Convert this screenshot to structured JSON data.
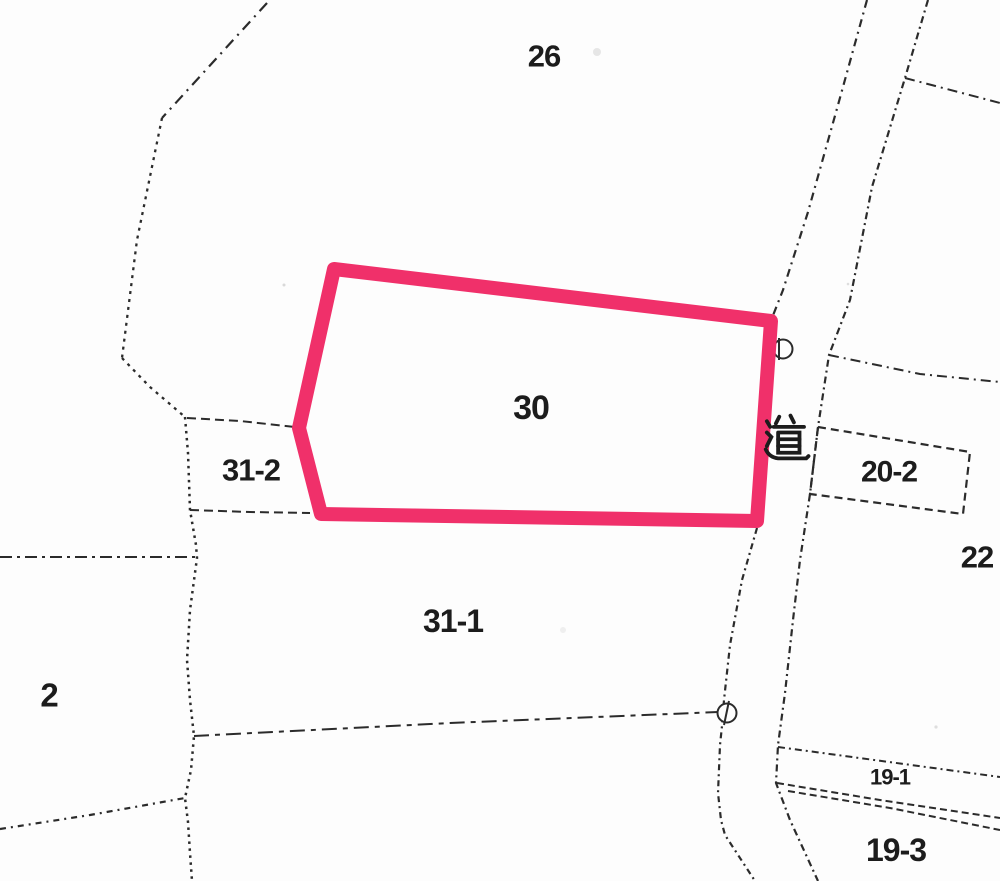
{
  "map": {
    "description": "cadastral-parcel-map",
    "canvas": {
      "width": 1000,
      "height": 881,
      "background": "#fdfdfd"
    },
    "colors": {
      "line": "#2b2b2b",
      "label": "#1c1c1c",
      "highlight": "#f0306a",
      "speck": "#c9c9c9"
    },
    "highlight_parcel": {
      "parcel": "30",
      "points": "334,269 771,321 757,521 321,514 299,428",
      "stroke_width": 14
    },
    "labels": [
      {
        "id": "parcel-26",
        "text": "26",
        "x": 544,
        "y": 56,
        "size": 31
      },
      {
        "id": "parcel-30",
        "text": "30",
        "x": 531,
        "y": 408,
        "size": 34
      },
      {
        "id": "parcel-31-2",
        "text": "31-2",
        "x": 251,
        "y": 470,
        "size": 31
      },
      {
        "id": "parcel-31-1",
        "text": "31-1",
        "x": 453,
        "y": 621,
        "size": 32
      },
      {
        "id": "parcel-2",
        "text": "2",
        "x": 49,
        "y": 695,
        "size": 33
      },
      {
        "id": "road-kanji",
        "text": "道",
        "x": 786,
        "y": 437,
        "size": 45,
        "kanji": true
      },
      {
        "id": "parcel-20-2",
        "text": "20-2",
        "x": 889,
        "y": 472,
        "size": 30
      },
      {
        "id": "parcel-22",
        "text": "22",
        "x": 977,
        "y": 557,
        "size": 31
      },
      {
        "id": "parcel-19-1",
        "text": "19-1",
        "x": 890,
        "y": 777,
        "size": 22
      },
      {
        "id": "parcel-19-3",
        "text": "19-3",
        "x": 896,
        "y": 850,
        "size": 32
      }
    ],
    "boundaries": [
      {
        "name": "northwest-chain-upper",
        "points": "267,3 162,118",
        "dash": "11 6 2 6",
        "width": 2.2
      },
      {
        "name": "northwest-dotted-mid",
        "points": "162,118 137,240 122,358",
        "dash": "3 5",
        "width": 2.3
      },
      {
        "name": "northwest-dotted-lower",
        "points": "122,358 150,387 185,417",
        "dash": "3 5",
        "width": 2.3
      },
      {
        "name": "west-vertical-dotted",
        "points": "185,417 188,453 190,510 196,545 197,558 190,610 187,660 190,700 194,736 191,770 185,798 188,822 190,853 192,881",
        "dash": "2.5 4.5",
        "width": 2.5
      },
      {
        "name": "parcel-31-2-top",
        "points": "187,418 240,421 295,427",
        "dash": "9 5",
        "width": 2
      },
      {
        "name": "parcel-31-2-bottom",
        "points": "190,510 250,512 310,513",
        "dash": "9 5",
        "width": 2
      },
      {
        "name": "west-horizontal",
        "points": "0,557 100,557 195,557",
        "dash": "12 5 3 5",
        "width": 2
      },
      {
        "name": "parcel-31-1-bottom",
        "points": "194,736 450,723 718,712",
        "dash": "15 6 5 6",
        "width": 2
      },
      {
        "name": "southwest-diagonal",
        "points": "0,829 90,815 185,798",
        "dash": "6 5 2 5",
        "width": 2.2
      },
      {
        "name": "road-left-upper",
        "points": "867,0 838,105 808,212 783,290 772,318",
        "dash": "8 5 2 5",
        "width": 2.2
      },
      {
        "name": "road-left-lower",
        "points": "757,528 742,580 730,645 724,700 722,726 720,745 718,793 721,820 725,835 755,881",
        "dash": "6 4 2 4",
        "width": 2.2
      },
      {
        "name": "road-right",
        "points": "928,0 905,78 872,187 850,300 829,355 818,427 810,494 800,560 793,620 785,693 778,745 776,783 790,820 818,881",
        "dash": "7 4 2 4",
        "width": 2.2
      },
      {
        "name": "northeast-branch",
        "points": "905,78 1000,103",
        "dash": "10 5 2 5",
        "width": 2
      },
      {
        "name": "east-branch",
        "points": "829,355 920,374 1000,382",
        "dash": "10 5 2 5",
        "width": 2
      },
      {
        "name": "parcel-20-2-box",
        "points": "818,427 970,452 963,514 810,494",
        "dash": "8 5",
        "width": 2.2,
        "closed": true
      },
      {
        "name": "parcel-19-1-top",
        "points": "778,747 1000,777",
        "dash": "7 4 2 4",
        "width": 2
      },
      {
        "name": "parcel-19-1-lower-a",
        "points": "777,783 880,800 1000,818",
        "dash": "7 4",
        "width": 2
      },
      {
        "name": "parcel-19-1-lower-b",
        "points": "788,791 890,808 1000,830",
        "dash": "7 4",
        "width": 2
      }
    ],
    "survey_markers": [
      {
        "name": "survey-marker-road-mid",
        "cx": 727,
        "cy": 713,
        "r": 9.5,
        "tick": "729,701 724,725"
      },
      {
        "name": "survey-marker-road-top",
        "cx": 783,
        "cy": 349,
        "r": 9.5,
        "tick": "779,338 779,360"
      }
    ],
    "specks": [
      {
        "x": 597,
        "y": 52,
        "r": 4,
        "opacity": 0.45
      },
      {
        "x": 284,
        "y": 285,
        "r": 1.5,
        "opacity": 0.7
      },
      {
        "x": 848,
        "y": 284,
        "r": 1.3,
        "opacity": 0.6
      },
      {
        "x": 936,
        "y": 727,
        "r": 1.6,
        "opacity": 0.6
      },
      {
        "x": 563,
        "y": 630,
        "r": 3,
        "opacity": 0.25
      }
    ]
  }
}
